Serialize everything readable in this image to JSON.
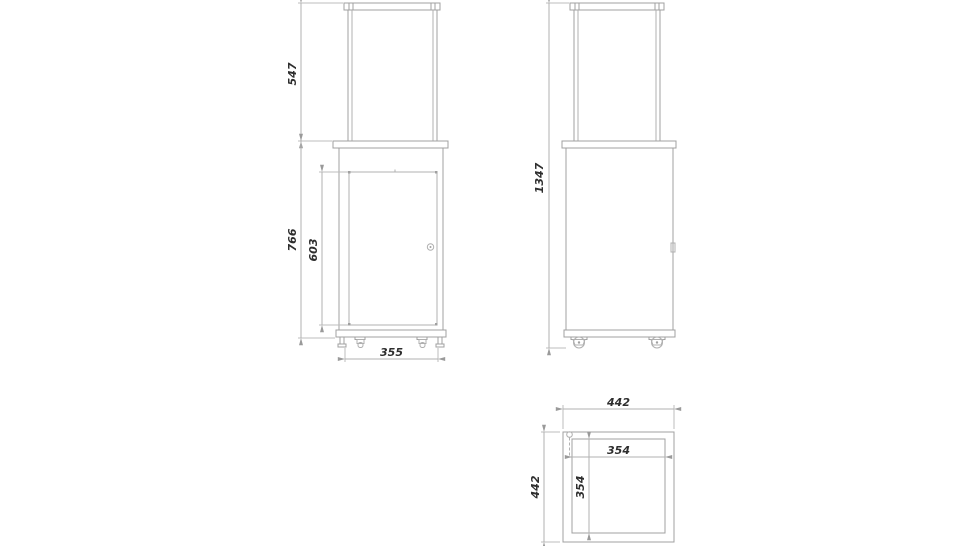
{
  "views": {
    "front": {
      "dims": {
        "glass_height": "547",
        "body_height": "766",
        "door_height": "603",
        "base_width": "355"
      }
    },
    "side": {
      "dims": {
        "total_height": "1347"
      }
    },
    "top": {
      "dims": {
        "outer_width": "442",
        "outer_depth": "442",
        "inner_width": "354",
        "inner_depth": "354"
      }
    }
  },
  "colors": {
    "line": "#a0a0a0",
    "dim_line": "#b2b2b2",
    "text": "#2e2e2e",
    "background": "#ffffff"
  }
}
